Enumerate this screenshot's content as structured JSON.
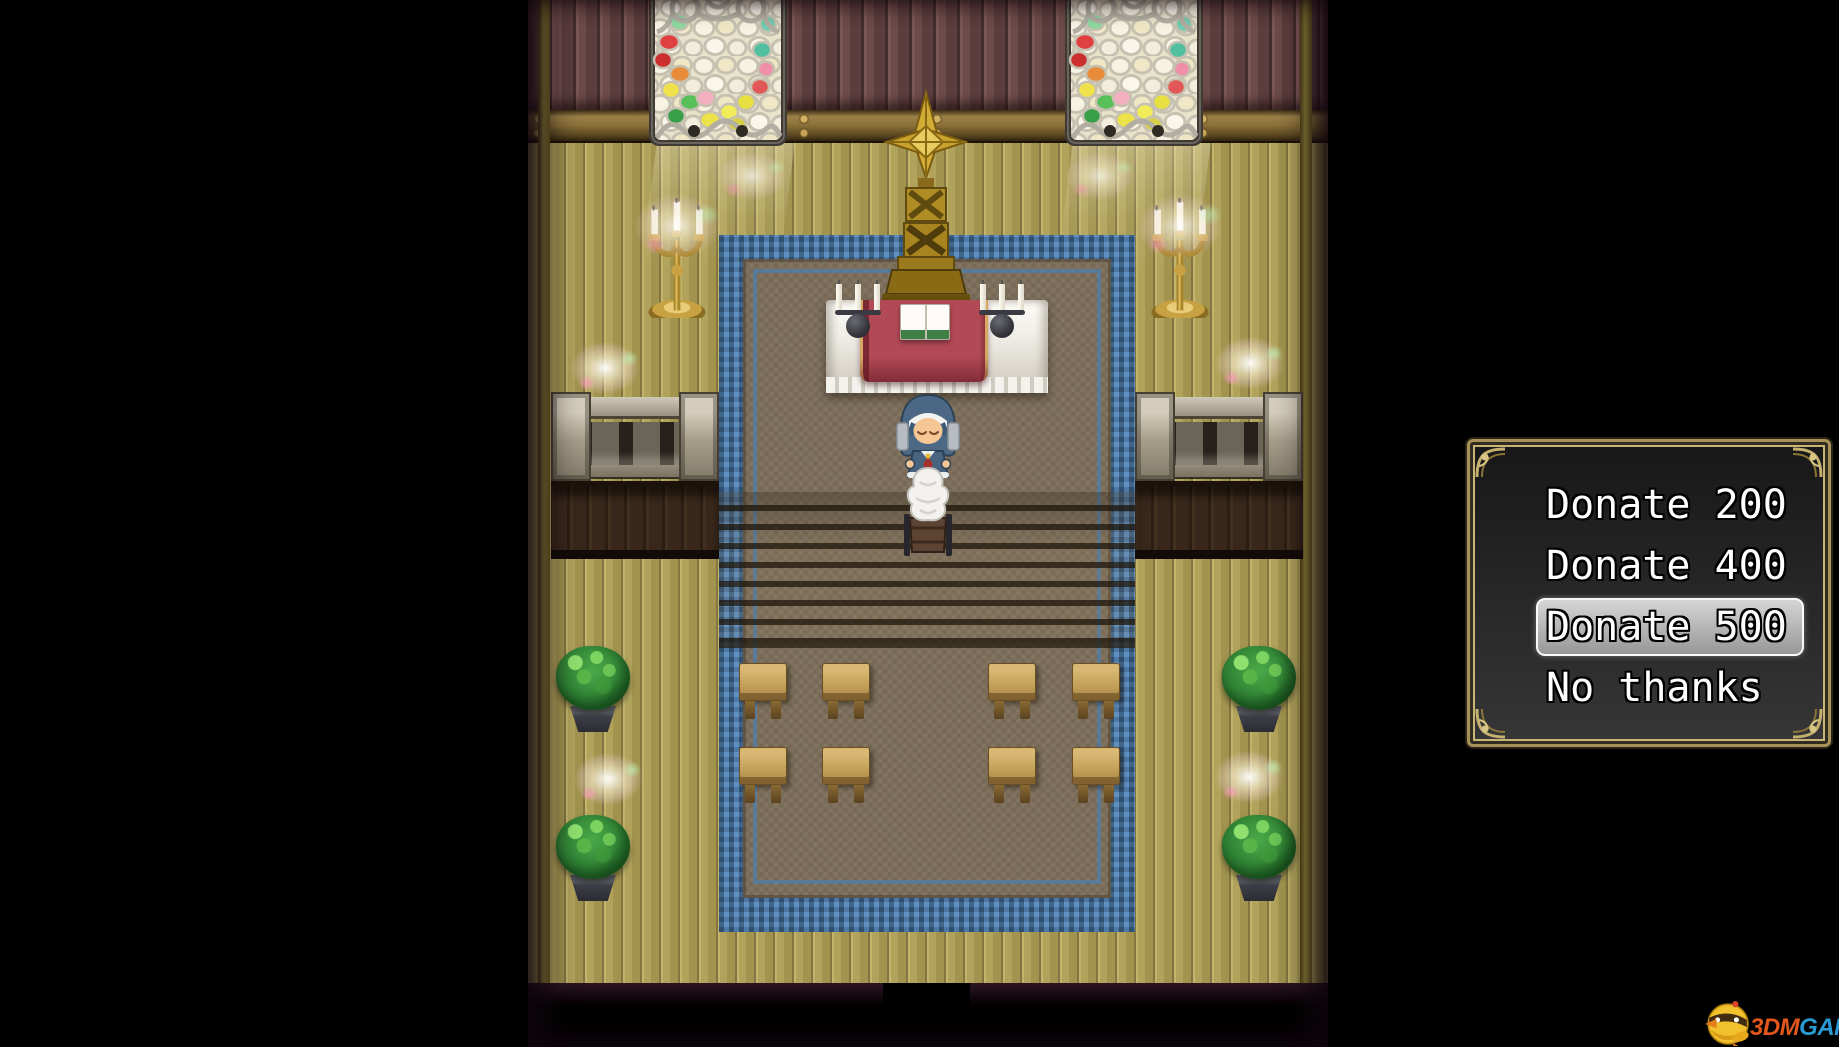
{
  "scene": {
    "name": "church-interior",
    "sprites": {
      "npc": "nun-priestess",
      "altar": "altar-table-with-open-book",
      "emblem": "gold-cross-emblem",
      "window": "stained-glass-window",
      "candelabra": "gold-floor-candelabra",
      "offering": "offering-stand",
      "bench": "wooden-bench",
      "plant": "potted-bush",
      "carpet": "blue-bordered-carpet",
      "doorway": "bottom-exit-doorway"
    }
  },
  "choice_menu": {
    "items": [
      {
        "label": "Donate 200",
        "selected": false
      },
      {
        "label": "Donate 400",
        "selected": false
      },
      {
        "label": "Donate 500",
        "selected": true
      },
      {
        "label": "No thanks",
        "selected": false
      }
    ],
    "selected_index": 2,
    "colors": {
      "frame_gold": "#c9b576",
      "text": "#ffffff",
      "highlight_fill": "#d6d6d6",
      "window_bg_top": "#181818",
      "window_bg_bottom": "#383838"
    }
  },
  "watermark": {
    "brand_left": "3DM",
    "brand_right": "GAME",
    "color_left": "#e2571b",
    "color_right": "#2a9ad4"
  }
}
